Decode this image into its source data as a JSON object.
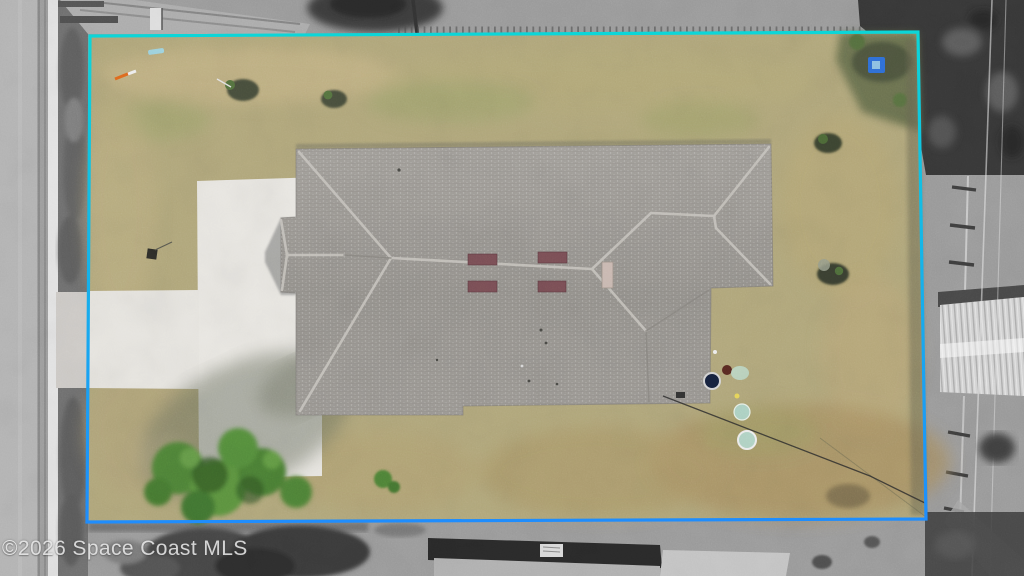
{
  "image_type": "aerial-drone-real-estate-photo",
  "watermark": {
    "text": "©2026 Space Coast MLS"
  },
  "boundary": {
    "shape": "rectangle around the lot",
    "color_top": "#0cd6d8",
    "color_bottom": "#1f8dfd",
    "stroke_width": "3.2"
  },
  "palette": {
    "lawn": "#b2a87c",
    "lawn_dry": "#c9b88a",
    "lawn_green": "#98a065",
    "backyard_brown": "#a99264",
    "roof_light": "#a4a19c",
    "roof_mid": "#96938e",
    "ridge_cap": "#c8c5bf",
    "vent_dark": "#7b4f56",
    "vent_light": "#cbbab3",
    "driveway": "#e9e7e2",
    "tree_green": "#4f8438",
    "road": "#b5b5b5",
    "curb": "#e4e4e4",
    "shoulder": "#707070",
    "surround_gray": "#9c9c9c",
    "trees_gray": "#3a3a3a",
    "shed_roof": "#d5d5d5",
    "neighbor_roof": "#2a2a2a",
    "concrete_pad": "#c6c6c6",
    "tarp_blue": "#2f6fd8"
  },
  "scene_objects": [
    {
      "name": "property-boundary",
      "desc": "cyan/blue rectangle outlining the lot; outside it the photo is desaturated grayscale"
    },
    {
      "name": "house-roof",
      "desc": "gray shingled hip roof of a single-family home seen top-down"
    },
    {
      "name": "garage-wing",
      "desc": "small hip-roof projection on the street (west) side"
    },
    {
      "name": "driveway",
      "desc": "white concrete apron beside the house with an entry strip to the street"
    },
    {
      "name": "street",
      "desc": "paved road with white edge stripe along the left edge"
    },
    {
      "name": "lawn",
      "desc": "dry tan and olive grass filling the lot"
    },
    {
      "name": "tree",
      "desc": "green leafy tree over the lower driveway casting a long shadow"
    },
    {
      "name": "front-shrubs",
      "desc": "two small mulched shrubs in the front yard"
    },
    {
      "name": "side-shrubs",
      "desc": "two shrubs along the east side of the lot"
    },
    {
      "name": "roof-vents",
      "desc": "four dark vents and one light vent near the ridge"
    },
    {
      "name": "backyard-items",
      "desc": "kettle grill and round pale pans behind the house"
    },
    {
      "name": "guy-wire",
      "desc": "thin cable running from the rear house corner toward the lot corner"
    },
    {
      "name": "metal-shed",
      "desc": "white corrugated metal roof on the east neighbor lot"
    },
    {
      "name": "neighbor-house",
      "desc": "rooftop clipped at the bottom edge of the frame"
    },
    {
      "name": "picket-fence",
      "desc": "fence ticks along the top boundary line"
    },
    {
      "name": "power-lines",
      "desc": "thin pale lines crossing the right-hand side"
    }
  ]
}
